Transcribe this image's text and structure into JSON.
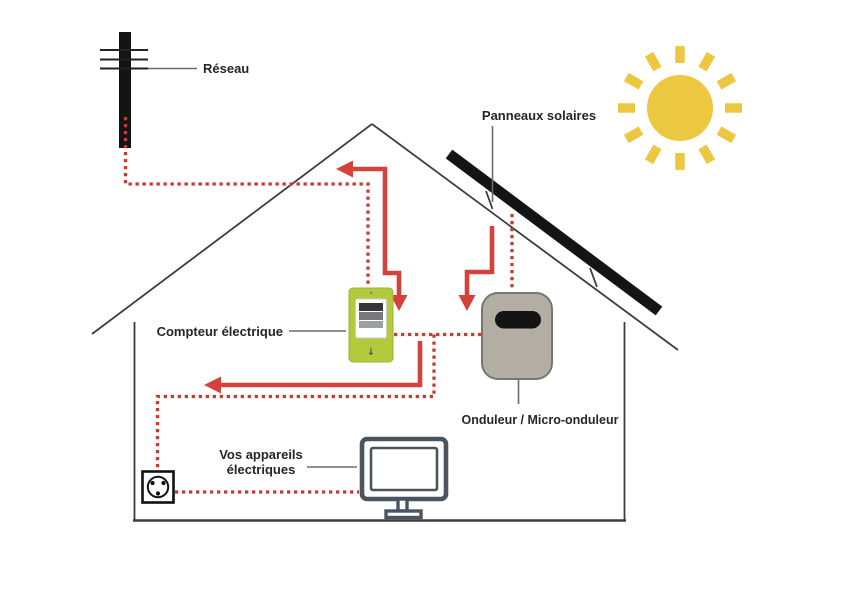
{
  "diagram": {
    "labels": {
      "grid": "Réseau",
      "solar_panels": "Panneaux solaires",
      "meter": "Compteur électrique",
      "inverter": "Onduleur / Micro-onduleur",
      "appliances_line1": "Vos appareils",
      "appliances_line2": "électriques"
    },
    "meter": {
      "indicator": "↓"
    },
    "icons": {
      "sun": "sun-icon",
      "utility_pole": "utility-pole-icon",
      "solar_panel": "solar-panel-icon",
      "electric_meter": "electric-meter-icon",
      "inverter": "inverter-icon",
      "power_outlet": "power-outlet-icon",
      "monitor": "monitor-icon",
      "house": "house-outline"
    }
  },
  "colors": {
    "sun": "#ebc840",
    "wire-red": "#c43c33",
    "arrow-red": "#d4433b",
    "meter-green": "#b3ca3d",
    "inverter-gray": "#b2aea4",
    "monitor-slate": "#4a5560",
    "device-black": "#141414",
    "line-dark": "#3d3d3d",
    "label-text": "#262626"
  }
}
